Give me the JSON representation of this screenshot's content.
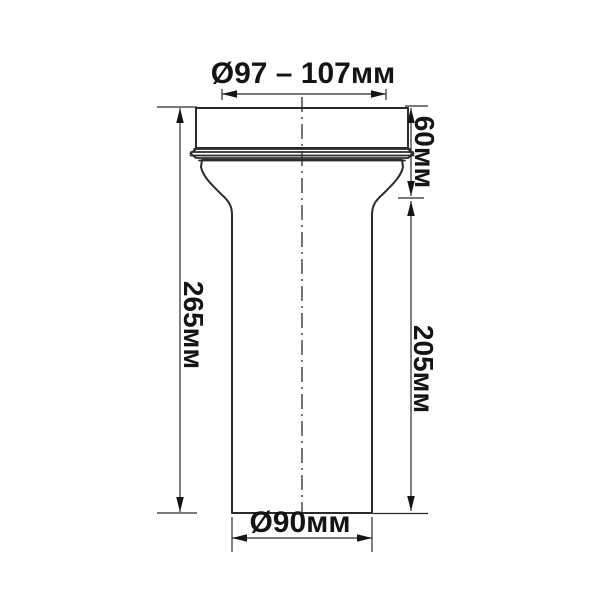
{
  "drawing": {
    "description": "dimensioned outline drawing of a WC pipe connector",
    "labels": {
      "top_diameter": "Ø97 – 107мм",
      "overall_height": "265мм",
      "socket_height": "60мм",
      "body_height": "205мм",
      "bottom_diameter": "Ø90мм"
    },
    "colors": {
      "background": "#ffffff",
      "line": "#2b2b2b",
      "text": "#141414"
    }
  }
}
